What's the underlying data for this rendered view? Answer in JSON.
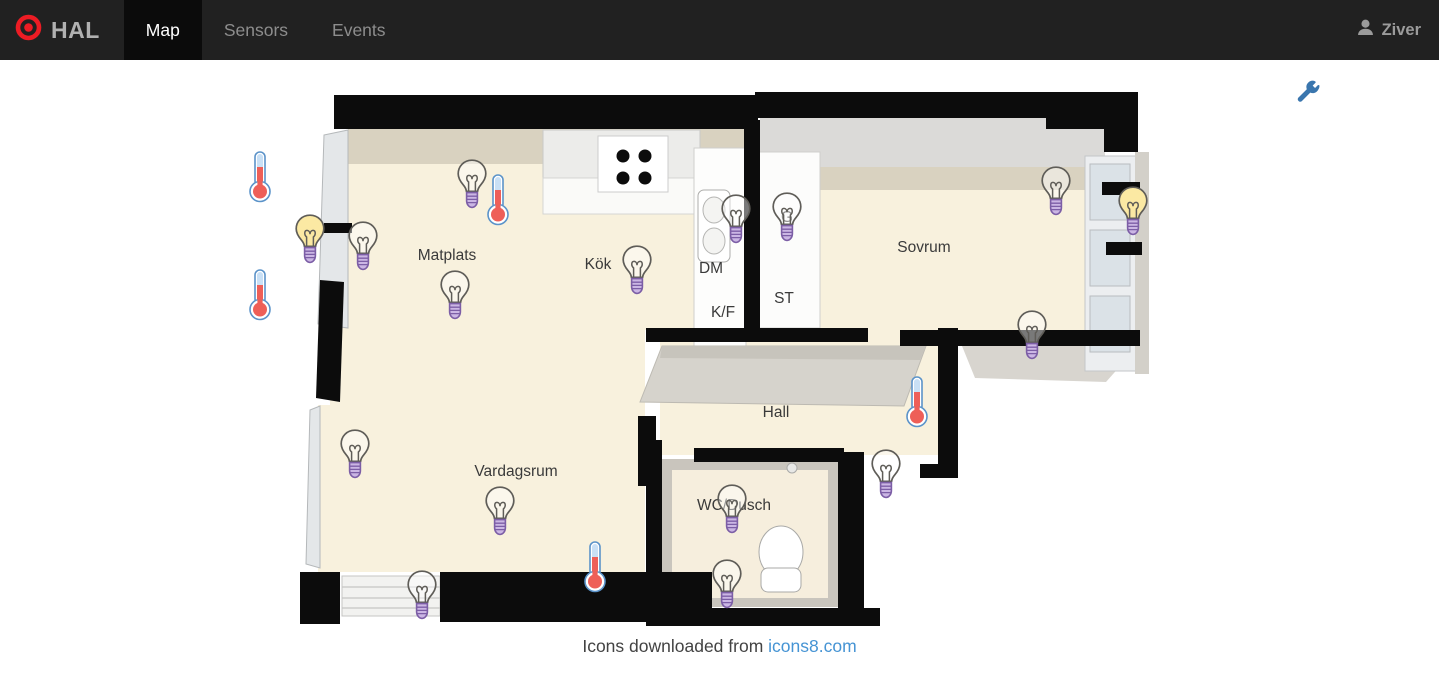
{
  "app": {
    "brand": "HAL",
    "nav": [
      {
        "label": "Map",
        "active": true
      },
      {
        "label": "Sensors",
        "active": false
      },
      {
        "label": "Events",
        "active": false
      }
    ],
    "user": "Ziver"
  },
  "map": {
    "rooms": [
      {
        "id": "matplats",
        "label": "Matplats",
        "x": 447,
        "y": 196
      },
      {
        "id": "kok",
        "label": "Kök",
        "x": 598,
        "y": 205
      },
      {
        "id": "dm",
        "label": "DM",
        "x": 711,
        "y": 209
      },
      {
        "id": "kf",
        "label": "K/F",
        "x": 723,
        "y": 253
      },
      {
        "id": "st",
        "label": "ST",
        "x": 784,
        "y": 239
      },
      {
        "id": "g",
        "label": "G",
        "x": 787,
        "y": 158
      },
      {
        "id": "sovrum",
        "label": "Sovrum",
        "x": 924,
        "y": 188
      },
      {
        "id": "hall",
        "label": "Hall",
        "x": 776,
        "y": 353
      },
      {
        "id": "vardagsrum",
        "label": "Vardagsrum",
        "x": 516,
        "y": 412
      },
      {
        "id": "wc-dusch",
        "label": "WC/Dusch",
        "x": 734,
        "y": 446
      }
    ],
    "sensors": [
      {
        "id": "temp-entry-upper",
        "type": "thermometer",
        "x": 260,
        "y": 117
      },
      {
        "id": "temp-entry-lower",
        "type": "thermometer",
        "x": 260,
        "y": 235
      },
      {
        "id": "temp-matplats",
        "type": "thermometer",
        "x": 498,
        "y": 140
      },
      {
        "id": "temp-hall",
        "type": "thermometer",
        "x": 917,
        "y": 342
      },
      {
        "id": "temp-vardagsrum",
        "type": "thermometer",
        "x": 595,
        "y": 507
      },
      {
        "id": "light-entry-on",
        "type": "bulb",
        "state": "on",
        "x": 310,
        "y": 180
      },
      {
        "id": "light-entry-off",
        "type": "bulb",
        "state": "off",
        "x": 363,
        "y": 187
      },
      {
        "id": "light-matplats-wall",
        "type": "bulb",
        "state": "off",
        "x": 472,
        "y": 125
      },
      {
        "id": "light-matplats",
        "type": "bulb",
        "state": "off",
        "x": 455,
        "y": 236
      },
      {
        "id": "light-kok",
        "type": "bulb",
        "state": "off",
        "x": 637,
        "y": 211
      },
      {
        "id": "light-dm-sink",
        "type": "bulb",
        "state": "off",
        "x": 736,
        "y": 160
      },
      {
        "id": "light-garderob",
        "type": "bulb",
        "state": "off",
        "x": 787,
        "y": 158
      },
      {
        "id": "light-sovrum-n",
        "type": "bulb",
        "state": "off",
        "x": 1056,
        "y": 132
      },
      {
        "id": "light-sovrum-balkong",
        "type": "bulb",
        "state": "on",
        "x": 1133,
        "y": 152
      },
      {
        "id": "light-sovrum-s",
        "type": "bulb",
        "state": "off",
        "x": 1032,
        "y": 276
      },
      {
        "id": "light-hall",
        "type": "bulb",
        "state": "off",
        "x": 886,
        "y": 415
      },
      {
        "id": "light-vardagsrum-w",
        "type": "bulb",
        "state": "off",
        "x": 355,
        "y": 395
      },
      {
        "id": "light-vardagsrum",
        "type": "bulb",
        "state": "off",
        "x": 500,
        "y": 452
      },
      {
        "id": "light-vardagsrum-s",
        "type": "bulb",
        "state": "off",
        "x": 422,
        "y": 536
      },
      {
        "id": "light-wc",
        "type": "bulb",
        "state": "off",
        "x": 732,
        "y": 450
      },
      {
        "id": "light-wc-s",
        "type": "bulb",
        "state": "off",
        "x": 727,
        "y": 525
      }
    ]
  },
  "footer": {
    "text": "Icons downloaded from ",
    "link": "icons8.com"
  },
  "colors": {
    "logo_red": "#ed1c24",
    "wrench_blue": "#3a76ae",
    "link_blue": "#4694d4",
    "bulb_on_fill": "#fbe9a3",
    "bulb_outline": "#5f5d58",
    "bulb_base_fill": "#cbb6e4",
    "bulb_base_stroke": "#7c5ea6",
    "thermo_red": "#ee5f58",
    "thermo_glass": "#c9e0f5",
    "thermo_stroke": "#5b93c9"
  }
}
